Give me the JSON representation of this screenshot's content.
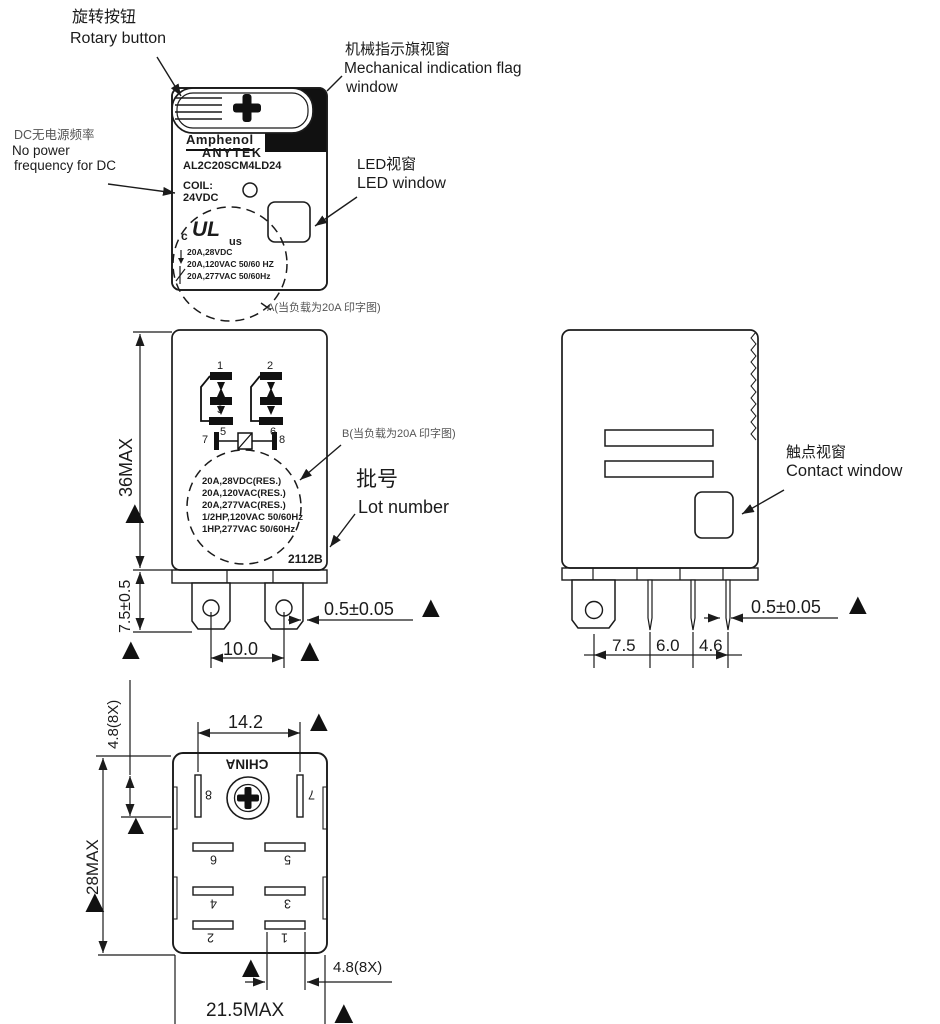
{
  "symbols": {
    "triangle": "▲"
  },
  "labels": {
    "rotary": {
      "zh": "旋转按钮",
      "en": "Rotary button"
    },
    "flag": {
      "zh": "机械指示旗视窗",
      "en1": "Mechanical indication flag",
      "en2": "window"
    },
    "dc": {
      "zh": "DC无电源频率",
      "en1": "No power",
      "en2": "frequency for DC"
    },
    "led": {
      "zh": "LED视窗",
      "en": "LED window"
    },
    "contact": {
      "zh": "触点视窗",
      "en": "Contact window"
    },
    "lot": {
      "zh": "批号",
      "en": "Lot number"
    },
    "print_a": "A(当负载为20A 印字图)",
    "print_b": "B(当负载为20A 印字图)"
  },
  "front": {
    "brand_top": "Amphenol",
    "brand_bottom": "ANYTEK",
    "model": "AL2C20SCM4LD24",
    "coil_label": "COIL:",
    "coil_value": "24VDC",
    "ul": {
      "c": "c",
      "logo": "UL",
      "us": "us"
    },
    "ratings": [
      "20A,28VDC",
      "20A,120VAC 50/60 HZ",
      "20A,277VAC 50/60Hz"
    ]
  },
  "side": {
    "pins": {
      "p1": "1",
      "p2": "2",
      "p3": "3",
      "p5": "5",
      "p6": "6",
      "p7": "7",
      "p8": "8"
    },
    "ratings": [
      "20A,28VDC(RES.)",
      "20A,120VAC(RES.)",
      "20A,277VAC(RES.)",
      "1/2HP,120VAC 50/60Hz",
      "1HP,277VAC 50/60Hz"
    ],
    "lot_value": "2112B"
  },
  "bottom": {
    "origin": "CHINA",
    "pins": [
      "1",
      "2",
      "3",
      "4",
      "5",
      "6",
      "7",
      "8"
    ]
  },
  "dims": {
    "height": "36MAX",
    "pin_len": "7.5±0.5",
    "pin_thick": "0.5±0.05",
    "pin_span": "10.0",
    "depth_pin_thick": "0.5±0.05",
    "d75": "7.5",
    "d60": "6.0",
    "d46": "4.6",
    "d142": "14.2",
    "slot_left": "4.8(8X)",
    "width": "28MAX",
    "slot_bottom": "4.8(8X)",
    "length": "21.5MAX"
  }
}
